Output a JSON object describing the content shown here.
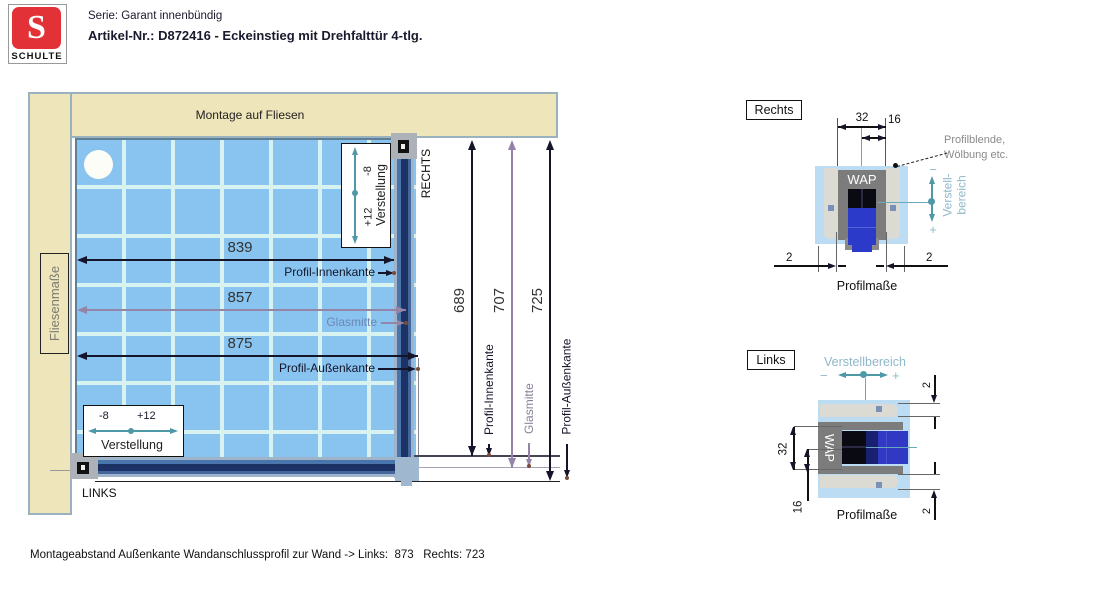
{
  "colors": {
    "logo_red": "#e23237",
    "wall_beige": "#efe5ba",
    "tile_blue": "#88c4ef",
    "grout": "#d8f2ef",
    "profile_navy": "#1c3264",
    "profile_steel": "#4a74ac",
    "dim_dark": "#14142a",
    "dim_purple": "#9484a8",
    "adjust_teal": "#4e98a8",
    "detail_teal": "#8fb8c8",
    "wap_gray": "#7c7c7c",
    "glass_blue": "#2b3ac8"
  },
  "header": {
    "logo_letter": "S",
    "brand": "SCHULTE",
    "serie": "Serie: Garant innenbündig",
    "artikel": "Artikel-Nr.: D872416 - Eckeinstieg mit Drehfalttür 4-tlg."
  },
  "plan": {
    "wall_label": "Montage auf Fliesen",
    "tile_box_label": "Fliesenmaße",
    "right_side_label": "RECHTS",
    "left_side_label": "LINKS",
    "adjust_right": {
      "minus": "-8",
      "plus": "+12",
      "label": "Verstellung"
    },
    "adjust_bottom": {
      "minus": "-8",
      "plus": "+12",
      "label": "Verstellung"
    },
    "width_dims": [
      {
        "value": "839",
        "label": "Profil-Innenkante"
      },
      {
        "value": "857",
        "label": "Glasmitte"
      },
      {
        "value": "875",
        "label": "Profil-Außenkante"
      }
    ],
    "height_dims": [
      {
        "value": "689",
        "label": "Profil-Innenkante"
      },
      {
        "value": "707",
        "label": "Glasmitte"
      },
      {
        "value": "725",
        "label": "Profil-Außenkante"
      }
    ]
  },
  "detail_right": {
    "title": "Rechts",
    "wap": "WAP",
    "dim_width": "32",
    "dim_half": "16",
    "dim_gap_left": "2",
    "dim_gap_right": "2",
    "blende_line1": "Profilblende,",
    "blende_line2": "Wölbung etc.",
    "verstell_line1": "Verstell-",
    "verstell_line2": "bereich",
    "minus": "−",
    "plus": "+",
    "caption": "Profilmaße"
  },
  "detail_left": {
    "title": "Links",
    "verstellbereich": "Verstellbereich",
    "minus": "−",
    "plus": "+",
    "wap": "WAP",
    "dim_width": "32",
    "dim_half": "16",
    "dim_gap_top": "2",
    "dim_gap_bottom": "2",
    "caption": "Profilmaße"
  },
  "footer": {
    "note": "Montageabstand Außenkante Wandanschlussprofil zur Wand -> Links:  873   Rechts: 723"
  }
}
